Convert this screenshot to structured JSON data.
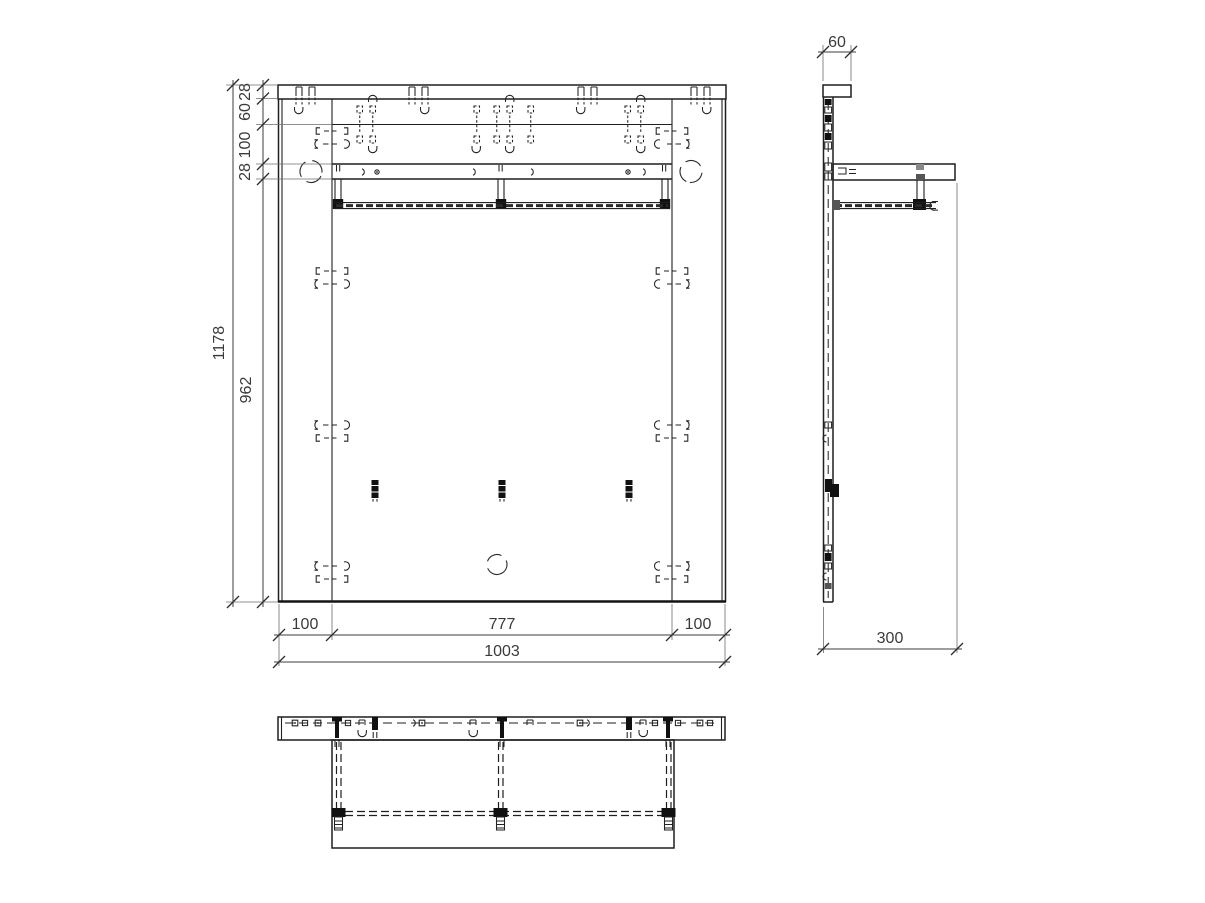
{
  "views": {
    "front": {
      "dims": {
        "total_height": "1178",
        "chain": [
          "28",
          "60",
          "100",
          "28"
        ],
        "body_height": "962",
        "bottom_chain": [
          "100",
          "777",
          "100"
        ],
        "total_width": "1003"
      }
    },
    "side": {
      "dims": {
        "top_depth": "60",
        "total_depth": "300"
      }
    }
  },
  "colors": {
    "line": "#1f1f1f",
    "dimension": "#3a3a3a",
    "background": "#ffffff"
  }
}
